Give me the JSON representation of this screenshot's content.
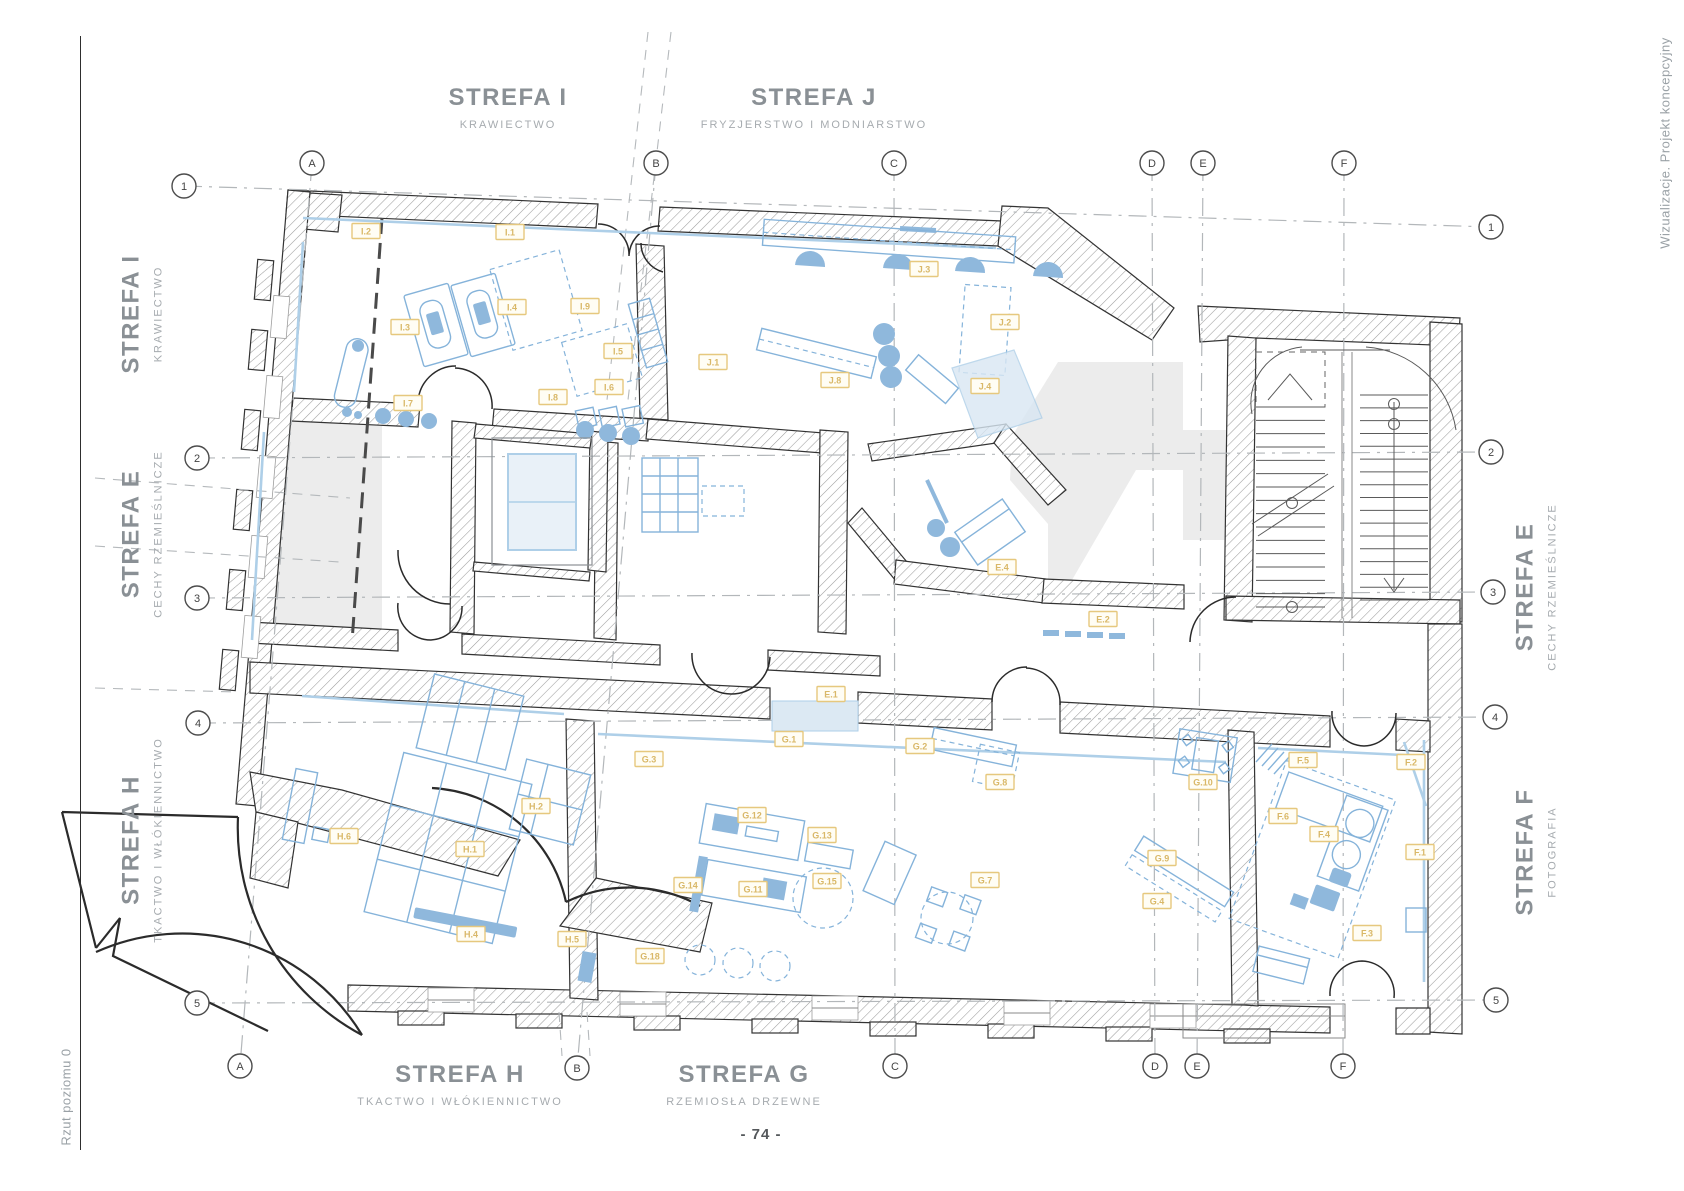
{
  "page": {
    "number": "- 74 -",
    "left_note": "Rzut poziomu 0",
    "right_note": "Wizualizacje. Projekt koncepcyjny"
  },
  "zone_labels": {
    "top": [
      {
        "title": "STREFA I",
        "subtitle": "KRAWIECTWO"
      },
      {
        "title": "STREFA J",
        "subtitle": "FRYZJERSTWO I MODNIARSTWO"
      }
    ],
    "left": [
      {
        "title": "STREFA I",
        "subtitle": "KRAWIECTWO"
      },
      {
        "title": "STREFA E",
        "subtitle": "CECHY RZEMIEŚLNICZE"
      },
      {
        "title": "STREFA H",
        "subtitle": "TKACTWO I WŁÓKIENNICTWO"
      }
    ],
    "right": [
      {
        "title": "STREFA E",
        "subtitle": "CECHY RZEMIEŚLNICZE"
      },
      {
        "title": "STREFA F",
        "subtitle": "FOTOGRAFIA"
      }
    ],
    "bottom": [
      {
        "title": "STREFA H",
        "subtitle": "TKACTWO I WŁÓKIENNICTWO"
      },
      {
        "title": "STREFA G",
        "subtitle": "RZEMIOSŁA DRZEWNE"
      }
    ]
  },
  "grid": {
    "cols": [
      {
        "label": "A",
        "c1": {
          "x": 312,
          "y": 163
        },
        "c2": {
          "x": 240,
          "y": 1066
        }
      },
      {
        "label": "B",
        "c1": {
          "x": 656,
          "y": 163
        },
        "c2": {
          "x": 577,
          "y": 1068
        }
      },
      {
        "label": "C",
        "c1": {
          "x": 894,
          "y": 163
        },
        "c2": {
          "x": 895,
          "y": 1066
        }
      },
      {
        "label": "D",
        "c1": {
          "x": 1152,
          "y": 163
        },
        "c2": {
          "x": 1155,
          "y": 1066
        }
      },
      {
        "label": "E",
        "c1": {
          "x": 1203,
          "y": 163
        },
        "c2": {
          "x": 1197,
          "y": 1066
        }
      },
      {
        "label": "F",
        "c1": {
          "x": 1344,
          "y": 163
        },
        "c2": {
          "x": 1343,
          "y": 1066
        }
      }
    ],
    "rows": [
      {
        "label": "1",
        "c1": {
          "x": 184,
          "y": 186
        },
        "c2": {
          "x": 1491,
          "y": 227
        }
      },
      {
        "label": "2",
        "c1": {
          "x": 197,
          "y": 458
        },
        "c2": {
          "x": 1491,
          "y": 452
        }
      },
      {
        "label": "3",
        "c1": {
          "x": 197,
          "y": 598
        },
        "c2": {
          "x": 1493,
          "y": 592
        }
      },
      {
        "label": "4",
        "c1": {
          "x": 198,
          "y": 723
        },
        "c2": {
          "x": 1495,
          "y": 717
        }
      },
      {
        "label": "5",
        "c1": {
          "x": 197,
          "y": 1003
        },
        "c2": {
          "x": 1496,
          "y": 1000
        }
      }
    ]
  },
  "room_tags": [
    {
      "label": "I.1",
      "x": 510,
      "y": 232
    },
    {
      "label": "I.2",
      "x": 366,
      "y": 231
    },
    {
      "label": "I.3",
      "x": 405,
      "y": 327
    },
    {
      "label": "I.4",
      "x": 512,
      "y": 307
    },
    {
      "label": "I.9",
      "x": 585,
      "y": 306
    },
    {
      "label": "I.5",
      "x": 618,
      "y": 351
    },
    {
      "label": "I.6",
      "x": 609,
      "y": 387
    },
    {
      "label": "I.7",
      "x": 408,
      "y": 403
    },
    {
      "label": "I.8",
      "x": 553,
      "y": 397
    },
    {
      "label": "J.1",
      "x": 713,
      "y": 362
    },
    {
      "label": "J.3",
      "x": 924,
      "y": 269
    },
    {
      "label": "J.8",
      "x": 835,
      "y": 380
    },
    {
      "label": "J.4",
      "x": 985,
      "y": 386
    },
    {
      "label": "J.2",
      "x": 1005,
      "y": 322
    },
    {
      "label": "E.4",
      "x": 1002,
      "y": 567
    },
    {
      "label": "E.2",
      "x": 1103,
      "y": 619
    },
    {
      "label": "E.1",
      "x": 831,
      "y": 694
    },
    {
      "label": "H.1",
      "x": 470,
      "y": 849
    },
    {
      "label": "H.2",
      "x": 536,
      "y": 806
    },
    {
      "label": "H.4",
      "x": 471,
      "y": 934
    },
    {
      "label": "H.5",
      "x": 572,
      "y": 939
    },
    {
      "label": "H.6",
      "x": 344,
      "y": 836
    },
    {
      "label": "G.1",
      "x": 789,
      "y": 739
    },
    {
      "label": "G.2",
      "x": 920,
      "y": 746
    },
    {
      "label": "G.3",
      "x": 649,
      "y": 759
    },
    {
      "label": "G.8",
      "x": 1000,
      "y": 782
    },
    {
      "label": "G.12",
      "x": 752,
      "y": 815
    },
    {
      "label": "G.13",
      "x": 822,
      "y": 835
    },
    {
      "label": "G.14",
      "x": 688,
      "y": 885
    },
    {
      "label": "G.11",
      "x": 753,
      "y": 889
    },
    {
      "label": "G.15",
      "x": 827,
      "y": 881
    },
    {
      "label": "G.7",
      "x": 985,
      "y": 880
    },
    {
      "label": "G.18",
      "x": 650,
      "y": 956
    },
    {
      "label": "G.10",
      "x": 1203,
      "y": 782
    },
    {
      "label": "G.9",
      "x": 1162,
      "y": 858
    },
    {
      "label": "G.4",
      "x": 1157,
      "y": 901
    },
    {
      "label": "F.1",
      "x": 1420,
      "y": 852
    },
    {
      "label": "F.2",
      "x": 1411,
      "y": 762
    },
    {
      "label": "F.3",
      "x": 1367,
      "y": 933
    },
    {
      "label": "F.4",
      "x": 1324,
      "y": 834
    },
    {
      "label": "F.5",
      "x": 1303,
      "y": 760
    },
    {
      "label": "F.6",
      "x": 1283,
      "y": 816
    }
  ],
  "colors": {
    "title_text": "#8a9095",
    "subtitle_text": "#a6abaf",
    "furniture_blue": "#85b3da",
    "sill_blue": "#aecfe8",
    "tag_border": "#e6c87e",
    "tag_text": "#d9b868",
    "wall_outline": "#333333",
    "grid_line": "#b3b7ba"
  }
}
